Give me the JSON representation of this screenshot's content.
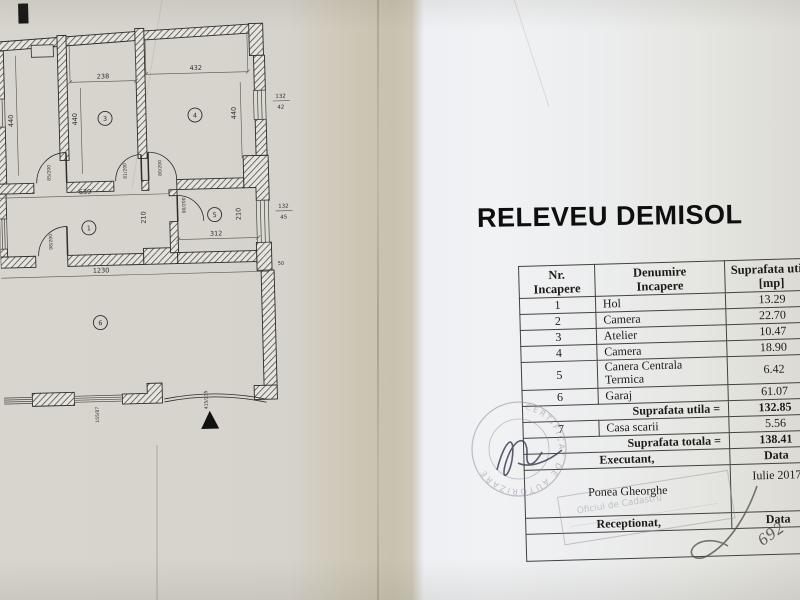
{
  "title": "RELEVEU DEMISOL",
  "table": {
    "header": {
      "c1a": "Nr.",
      "c1b": "Incapere",
      "c2a": "Denumire",
      "c2b": "Incapere",
      "c3a": "Suprafata utila",
      "c3b": "[mp]"
    },
    "rows": [
      {
        "nr": "1",
        "name": "Hol",
        "area": "13.29"
      },
      {
        "nr": "2",
        "name": "Camera",
        "area": "22.70"
      },
      {
        "nr": "3",
        "name": "Atelier",
        "area": "10.47"
      },
      {
        "nr": "4",
        "name": "Camera",
        "area": "18.90"
      },
      {
        "nr": "5",
        "name": "Canera Centrala Termica",
        "area": "6.42"
      },
      {
        "nr": "6",
        "name": "Garaj",
        "area": "61.07"
      }
    ],
    "subtotal": {
      "label": "Suprafata utila =",
      "value": "132.85"
    },
    "row7": {
      "nr": "7",
      "name": "Casa scarii",
      "area": "5.56"
    },
    "total": {
      "label": "Suprafata totala =",
      "value": "138.41"
    },
    "executant": {
      "label": "Executant,",
      "data": "Data"
    },
    "signer": {
      "name": "Ponea Gheorghe",
      "date": "Iulie 2017"
    },
    "receptionat": {
      "label": "Receptionat,",
      "data": "Data"
    }
  },
  "plan": {
    "rooms": {
      "hall": "1",
      "room3": "3",
      "room4": "4",
      "room5": "5",
      "garage": "6"
    },
    "dims": {
      "d238": "238",
      "d432": "432",
      "d440a": "440",
      "d440b": "440",
      "d440c": "440",
      "d639": "639",
      "d210a": "210",
      "d210b": "210",
      "d312": "312",
      "d1230": "1230",
      "d50": "50",
      "w1n": "132",
      "w1d": "42",
      "w2n": "132",
      "w2d": "45",
      "door1": "85/200",
      "door2": "81/200",
      "door3": "80/200",
      "door4": "90/200",
      "door5": "98/200",
      "g1": "155/87",
      "g2": "415/235"
    }
  },
  "stamps": {
    "round_text": "CERTIFICAT DE AUTORIZARE",
    "rect_line1": "Oficiul de Cadastru"
  },
  "annotations": {
    "handwritten_number": "692"
  }
}
